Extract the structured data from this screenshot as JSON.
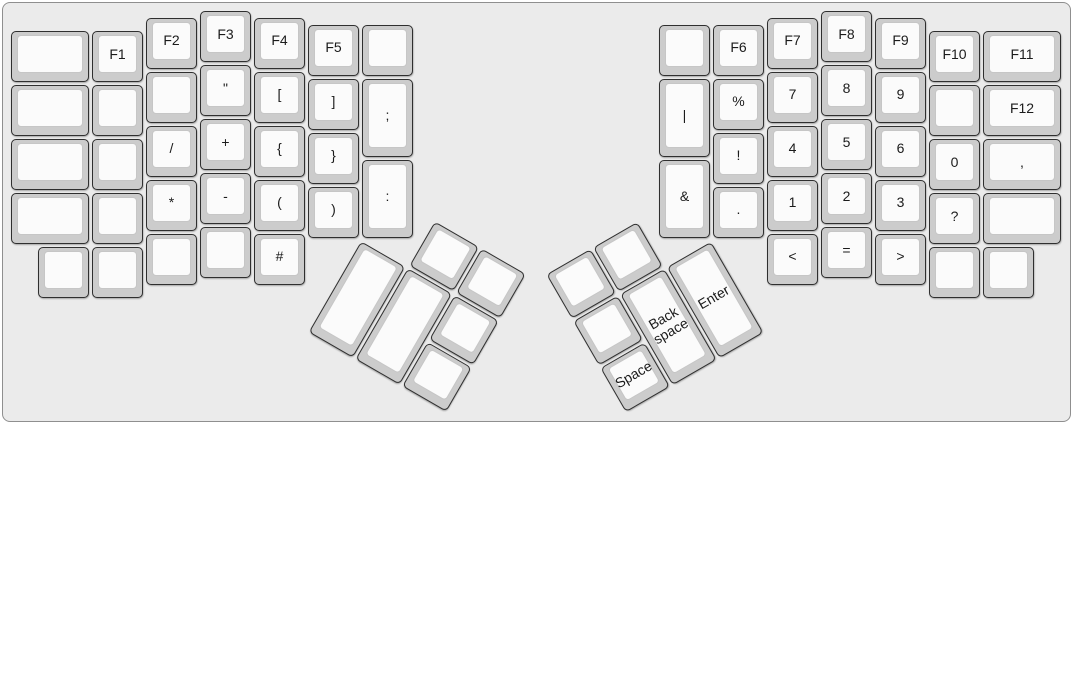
{
  "board": {
    "unit_px": 54,
    "origin_px": [
      10,
      10
    ],
    "palette": {
      "board_bg": "#ebebeb",
      "frame_line": "#8f8f8f",
      "keycap_bezel": "#cccccc",
      "keycap_top": "#fbfbfb",
      "keycap_outline": "#2f2f2f",
      "keycap_inner_line": "#c6c6c6",
      "key_text": "#1b1b1b"
    },
    "groups": [
      {
        "name": "left-hand",
        "r": 0,
        "rx": 0,
        "ry": 0,
        "keys": [
          {
            "x": 0,
            "y": 0.375,
            "w": 1.5,
            "label": ""
          },
          {
            "x": 0,
            "y": 1.375,
            "w": 1.5,
            "label": ""
          },
          {
            "x": 0,
            "y": 2.375,
            "w": 1.5,
            "label": ""
          },
          {
            "x": 0,
            "y": 3.375,
            "w": 1.5,
            "label": ""
          },
          {
            "x": 1.5,
            "y": 0.375,
            "label": "F1"
          },
          {
            "x": 1.5,
            "y": 1.375,
            "label": ""
          },
          {
            "x": 1.5,
            "y": 2.375,
            "label": ""
          },
          {
            "x": 1.5,
            "y": 3.375,
            "label": ""
          },
          {
            "x": 2.5,
            "y": 0.125,
            "label": "F2"
          },
          {
            "x": 2.5,
            "y": 1.125,
            "label": ""
          },
          {
            "x": 2.5,
            "y": 2.125,
            "label": "/"
          },
          {
            "x": 2.5,
            "y": 3.125,
            "label": "*"
          },
          {
            "x": 2.5,
            "y": 4.125,
            "label": ""
          },
          {
            "x": 3.5,
            "y": 0,
            "label": "F3"
          },
          {
            "x": 3.5,
            "y": 1,
            "label": "\""
          },
          {
            "x": 3.5,
            "y": 2,
            "label": "+"
          },
          {
            "x": 3.5,
            "y": 3,
            "label": "-"
          },
          {
            "x": 3.5,
            "y": 4,
            "label": ""
          },
          {
            "x": 4.5,
            "y": 0.125,
            "label": "F4"
          },
          {
            "x": 4.5,
            "y": 1.125,
            "label": "["
          },
          {
            "x": 4.5,
            "y": 2.125,
            "label": "{"
          },
          {
            "x": 4.5,
            "y": 3.125,
            "label": "("
          },
          {
            "x": 4.5,
            "y": 4.125,
            "label": "#"
          },
          {
            "x": 5.5,
            "y": 0.25,
            "label": "F5"
          },
          {
            "x": 5.5,
            "y": 1.25,
            "label": "]"
          },
          {
            "x": 5.5,
            "y": 2.25,
            "label": "}"
          },
          {
            "x": 5.5,
            "y": 3.25,
            "label": ")"
          },
          {
            "x": 6.5,
            "y": 0.25,
            "label": ""
          },
          {
            "x": 6.5,
            "y": 1.25,
            "h": 1.5,
            "label": ";"
          },
          {
            "x": 6.5,
            "y": 2.75,
            "h": 1.5,
            "label": ":"
          },
          {
            "x": 0.5,
            "y": 4.375,
            "label": ""
          },
          {
            "x": 1.5,
            "y": 4.375,
            "label": ""
          }
        ]
      },
      {
        "name": "right-hand",
        "r": 0,
        "rx": 0,
        "ry": 0,
        "keys": [
          {
            "x": 12,
            "y": 0.25,
            "label": ""
          },
          {
            "x": 12,
            "y": 1.25,
            "h": 1.5,
            "label": "|"
          },
          {
            "x": 12,
            "y": 2.75,
            "h": 1.5,
            "label": "&"
          },
          {
            "x": 13,
            "y": 0.25,
            "label": "F6"
          },
          {
            "x": 13,
            "y": 1.25,
            "label": "%"
          },
          {
            "x": 13,
            "y": 2.25,
            "label": "!"
          },
          {
            "x": 13,
            "y": 3.25,
            "label": "."
          },
          {
            "x": 14,
            "y": 0.125,
            "label": "F7"
          },
          {
            "x": 14,
            "y": 1.125,
            "label": "7"
          },
          {
            "x": 14,
            "y": 2.125,
            "label": "4"
          },
          {
            "x": 14,
            "y": 3.125,
            "label": "1"
          },
          {
            "x": 14,
            "y": 4.125,
            "label": "<"
          },
          {
            "x": 15,
            "y": 0,
            "label": "F8"
          },
          {
            "x": 15,
            "y": 1,
            "label": "8"
          },
          {
            "x": 15,
            "y": 2,
            "label": "5"
          },
          {
            "x": 15,
            "y": 3,
            "label": "2"
          },
          {
            "x": 15,
            "y": 4,
            "label": "="
          },
          {
            "x": 16,
            "y": 0.125,
            "label": "F9"
          },
          {
            "x": 16,
            "y": 1.125,
            "label": "9"
          },
          {
            "x": 16,
            "y": 2.125,
            "label": "6"
          },
          {
            "x": 16,
            "y": 3.125,
            "label": "3"
          },
          {
            "x": 16,
            "y": 4.125,
            "label": ">"
          },
          {
            "x": 17,
            "y": 0.375,
            "label": "F10"
          },
          {
            "x": 17,
            "y": 1.375,
            "label": ""
          },
          {
            "x": 17,
            "y": 2.375,
            "label": "0"
          },
          {
            "x": 17,
            "y": 3.375,
            "label": "?"
          },
          {
            "x": 17,
            "y": 4.375,
            "label": ""
          },
          {
            "x": 18,
            "y": 0.375,
            "w": 1.5,
            "label": "F11"
          },
          {
            "x": 18,
            "y": 1.375,
            "w": 1.5,
            "label": "F12"
          },
          {
            "x": 18,
            "y": 2.375,
            "w": 1.5,
            "label": ","
          },
          {
            "x": 18,
            "y": 3.375,
            "w": 1.5,
            "label": ""
          },
          {
            "x": 18,
            "y": 4.375,
            "label": ""
          }
        ]
      },
      {
        "name": "left-thumb-cluster",
        "r": 30,
        "rx": 6.5,
        "ry": 4.25,
        "keys": [
          {
            "x": 1,
            "y": -1,
            "label": ""
          },
          {
            "x": 2,
            "y": -1,
            "label": ""
          },
          {
            "x": 0,
            "y": 0,
            "h": 2,
            "label": ""
          },
          {
            "x": 1,
            "y": 0,
            "h": 2,
            "label": ""
          },
          {
            "x": 2,
            "y": 0,
            "label": ""
          },
          {
            "x": 2,
            "y": 1,
            "label": ""
          }
        ]
      },
      {
        "name": "right-thumb-cluster",
        "r": -30,
        "rx": 13,
        "ry": 4.25,
        "keys": [
          {
            "x": -3,
            "y": -1,
            "label": ""
          },
          {
            "x": -2,
            "y": -1,
            "label": ""
          },
          {
            "x": -3,
            "y": 0,
            "label": ""
          },
          {
            "x": -2,
            "y": 0,
            "h": 2,
            "label": "Back space"
          },
          {
            "x": -1,
            "y": 0,
            "h": 2,
            "label": "Enter"
          },
          {
            "x": -3,
            "y": 1,
            "label": "Space"
          }
        ]
      }
    ]
  }
}
